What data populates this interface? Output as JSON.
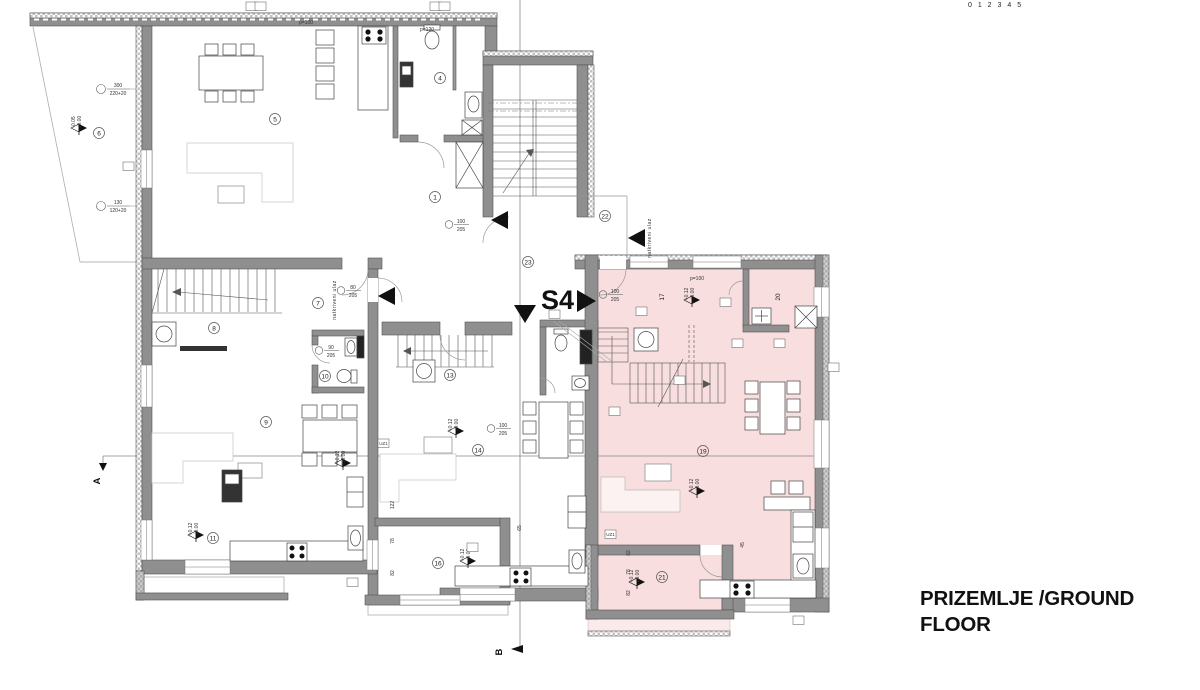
{
  "title": {
    "line1": "PRIZEMLJE /GROUND",
    "line2": "FLOOR"
  },
  "unit_label": "S4",
  "section_a": "A",
  "section_b": "B",
  "scale_fragment": "0 1 2 3 4 5",
  "covered_entrance_text": "natkriveni ulaz",
  "colors": {
    "unit_fill": "#f8dede",
    "terrace_fill": "#fbeaea",
    "wall": "#8f8f8f",
    "wall_dark": "#545454",
    "accent_black": "#111111"
  },
  "room_markers": [
    {
      "n": "1",
      "x": 435,
      "y": 197
    },
    {
      "n": "4",
      "x": 440,
      "y": 78
    },
    {
      "n": "5",
      "x": 275,
      "y": 119
    },
    {
      "n": "6",
      "x": 99,
      "y": 133
    },
    {
      "n": "7",
      "x": 318,
      "y": 303
    },
    {
      "n": "8",
      "x": 214,
      "y": 328
    },
    {
      "n": "9",
      "x": 266,
      "y": 422
    },
    {
      "n": "10",
      "x": 325,
      "y": 376
    },
    {
      "n": "11",
      "x": 213,
      "y": 538
    },
    {
      "n": "13",
      "x": 450,
      "y": 375
    },
    {
      "n": "14",
      "x": 478,
      "y": 450
    },
    {
      "n": "16",
      "x": 438,
      "y": 563
    },
    {
      "n": "19",
      "x": 703,
      "y": 451
    },
    {
      "n": "21",
      "x": 662,
      "y": 577
    },
    {
      "n": "22",
      "x": 605,
      "y": 216
    },
    {
      "n": "23",
      "x": 528,
      "y": 262
    }
  ],
  "rotated_room_labels": [
    {
      "t": "17",
      "x": 664,
      "y": 297
    },
    {
      "t": "20",
      "x": 780,
      "y": 297
    }
  ],
  "wall_dims": [
    {
      "l1": "300",
      "l2": "220+20",
      "x": 104,
      "y": 86
    },
    {
      "l1": "130",
      "l2": "120+20",
      "x": 104,
      "y": 203
    }
  ],
  "door_dims": [
    {
      "l1": "100",
      "l2": "205",
      "x": 458,
      "y": 222
    },
    {
      "l1": "80",
      "l2": "205",
      "x": 350,
      "y": 288
    },
    {
      "l1": "90",
      "l2": "205",
      "x": 328,
      "y": 348
    },
    {
      "l1": "100",
      "l2": "205",
      "x": 500,
      "y": 426
    },
    {
      "l1": "100",
      "l2": "205",
      "x": 612,
      "y": 292
    }
  ],
  "small_dims": [
    {
      "t": "p=100",
      "x": 306,
      "y": 24,
      "r": 0
    },
    {
      "t": "p=120",
      "x": 427,
      "y": 31,
      "r": 0
    },
    {
      "t": "p=100",
      "x": 697,
      "y": 280,
      "r": 0
    },
    {
      "t": "122",
      "x": 394,
      "y": 505,
      "r": 1
    },
    {
      "t": "78",
      "x": 394,
      "y": 541,
      "r": 1
    },
    {
      "t": "82",
      "x": 394,
      "y": 573,
      "r": 1
    },
    {
      "t": "82",
      "x": 630,
      "y": 553,
      "r": 1
    },
    {
      "t": "78",
      "x": 630,
      "y": 572,
      "r": 1
    },
    {
      "t": "82",
      "x": 630,
      "y": 593,
      "r": 1
    },
    {
      "t": "65",
      "x": 521,
      "y": 528,
      "r": 1
    },
    {
      "t": "45",
      "x": 744,
      "y": 545,
      "r": 1
    }
  ],
  "elevation_markers": [
    {
      "x": 79,
      "y": 133,
      "t1": "-0.05",
      "t2": "±0.00"
    },
    {
      "x": 343,
      "y": 468,
      "t1": "+0.12",
      "t2": "±0.00"
    },
    {
      "x": 692,
      "y": 305,
      "t1": "+0.12",
      "t2": "±0.00"
    },
    {
      "x": 697,
      "y": 496,
      "t1": "+0.12",
      "t2": "±0.00"
    },
    {
      "x": 637,
      "y": 587,
      "t1": "+0.12",
      "t2": "±0.00"
    },
    {
      "x": 196,
      "y": 540,
      "t1": "+0.12",
      "t2": "±0.00"
    },
    {
      "x": 468,
      "y": 566,
      "t1": "+0.12",
      "t2": "±0.00"
    },
    {
      "x": 456,
      "y": 436,
      "t1": "+0.12",
      "t2": "±0.00"
    }
  ],
  "boxed_labels": [
    {
      "t": "UZ1",
      "x": 378,
      "y": 439
    },
    {
      "t": "UZ1",
      "x": 605,
      "y": 530
    },
    {
      "t": "",
      "x": 123,
      "y": 162
    },
    {
      "t": "",
      "x": 636,
      "y": 307
    },
    {
      "t": "",
      "x": 720,
      "y": 298
    },
    {
      "t": "",
      "x": 732,
      "y": 339
    },
    {
      "t": "",
      "x": 774,
      "y": 339
    },
    {
      "t": "",
      "x": 674,
      "y": 376
    },
    {
      "t": "",
      "x": 609,
      "y": 407
    },
    {
      "t": "",
      "x": 828,
      "y": 363
    },
    {
      "t": "",
      "x": 347,
      "y": 578
    },
    {
      "t": "",
      "x": 467,
      "y": 543
    },
    {
      "t": "",
      "x": 549,
      "y": 310
    },
    {
      "t": "",
      "x": 246,
      "y": 2
    },
    {
      "t": "",
      "x": 255,
      "y": 2
    },
    {
      "t": "",
      "x": 430,
      "y": 2
    },
    {
      "t": "",
      "x": 439,
      "y": 2
    },
    {
      "t": "",
      "x": 793,
      "y": 616
    }
  ],
  "entrance_arrows": [
    {
      "x": 508,
      "y": 220,
      "dir": "left"
    },
    {
      "x": 395,
      "y": 296,
      "dir": "left"
    },
    {
      "x": 645,
      "y": 238,
      "dir": "left"
    },
    {
      "x": 525,
      "y": 305,
      "dir": "down"
    }
  ],
  "covered_entrance_positions": [
    {
      "x": 336,
      "y": 300
    },
    {
      "x": 651,
      "y": 238
    }
  ]
}
